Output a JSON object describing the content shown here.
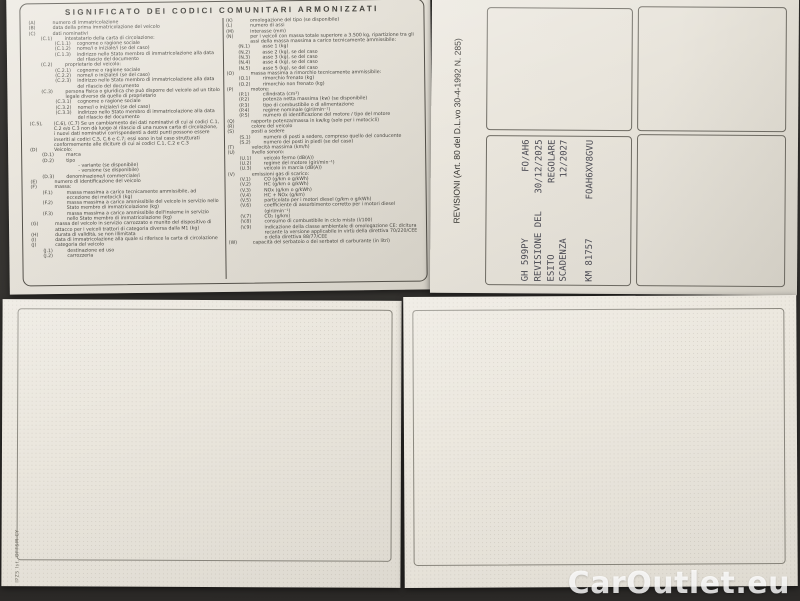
{
  "photo": {
    "watermark": "CarOutlet.eu",
    "edge_print": "IPZS Ist. OFFSM-CY"
  },
  "legend": {
    "title": "SIGNIFICATO DEI CODICI COMUNITARI ARMONIZZATI",
    "left": [
      {
        "code": "(A)",
        "text": "numero di immatricolazione",
        "level": 0
      },
      {
        "code": "(B)",
        "text": "data della prima immatricolazione del veicolo",
        "level": 0
      },
      {
        "code": "(C)",
        "text": "dati nominativi",
        "level": 0
      },
      {
        "code": "(C.1)",
        "text": "intestatario della carta di circolazione:",
        "level": 1
      },
      {
        "code": "(C.1.1)",
        "text": "cognome o ragione sociale",
        "level": 2
      },
      {
        "code": "(C.1.2)",
        "text": "nome/i o iniziale/i (se del caso)",
        "level": 2
      },
      {
        "code": "(C.1.3)",
        "text": "indirizzo nello Stato membro di immatricolazione alla data del rilascio del documento",
        "level": 2
      },
      {
        "code": "(C.2)",
        "text": "proprietario del veicolo:",
        "level": 1
      },
      {
        "code": "(C.2.1)",
        "text": "cognome o ragione sociale",
        "level": 2
      },
      {
        "code": "(C.2.2)",
        "text": "nome/i o iniziale/i (se del caso)",
        "level": 2
      },
      {
        "code": "(C.2.3)",
        "text": "indirizzo nello Stato membro di immatricolazione alla data del rilascio del documento",
        "level": 2
      },
      {
        "code": "(C.3)",
        "text": "persona fisica o giuridica che può disporre del veicolo ad un titolo legale diverso da quello di proprietario",
        "level": 1
      },
      {
        "code": "(C.3.1)",
        "text": "cognome o ragione sociale",
        "level": 2
      },
      {
        "code": "(C.3.2)",
        "text": "nome/i o iniziale/i (se del caso)",
        "level": 2
      },
      {
        "code": "(C.3.3)",
        "text": "indirizzo nello Stato membro di immatricolazione alla data del rilascio del documento",
        "level": 2
      },
      {
        "code": "(C.5),",
        "text": "(C.6), (C.7) Se un cambiamento dei dati nominativi di cui ai codici C.1, C.2 e/o C.3 non dà luogo al rilascio di una nuova carta di circolazione, i nuovi dati nominativi corrispondenti a detti punti possono essere inseriti ai codici C.5, C.6 e C.7; essi sono in tal caso strutturati conformemente alle diciture di cui ai codici C.1, C.2 e C.3",
        "level": 0
      },
      {
        "code": "(D)",
        "text": "Veicolo:",
        "level": 0
      },
      {
        "code": "(D.1)",
        "text": "marca",
        "level": 1
      },
      {
        "code": "(D.2)",
        "text": "tipo",
        "level": 1
      },
      {
        "code": "",
        "text": "- variante (se disponibile)",
        "level": 2
      },
      {
        "code": "",
        "text": "- versione (se disponibile)",
        "level": 2
      },
      {
        "code": "(D.3)",
        "text": "denominazione/i commerciale/i",
        "level": 1
      },
      {
        "code": "(E)",
        "text": "numero di identificazione del veicolo",
        "level": 0
      },
      {
        "code": "(F)",
        "text": "massa:",
        "level": 0
      },
      {
        "code": "(F.1)",
        "text": "massa massima a carico tecnicamente ammissibile, ad eccezione dei motocicli (kg)",
        "level": 1
      },
      {
        "code": "(F.2)",
        "text": "massa massima a carico ammissibile del veicolo in servizio nello Stato membro di immatricolazione (kg)",
        "level": 1
      },
      {
        "code": "(F.3)",
        "text": "massa massima a carico ammissibile dell'insieme in servizio nello Stato membro di immatricolazione (kg)",
        "level": 1
      },
      {
        "code": "(G)",
        "text": "massa del veicolo in servizio carrozzato e munito del dispositivo di attacco per i veicoli trattori di categoria diversa dalla M1 (kg)",
        "level": 0
      },
      {
        "code": "(H)",
        "text": "durata di validità, se non illimitata",
        "level": 0
      },
      {
        "code": "(I)",
        "text": "data di immatricolazione alla quale si riferisce la carta di circolazione",
        "level": 0
      },
      {
        "code": "(J)",
        "text": "categoria del veicolo",
        "level": 0
      },
      {
        "code": "(J.1)",
        "text": "destinazione ed uso",
        "level": 1
      },
      {
        "code": "(J.2)",
        "text": "carrozzeria",
        "level": 1
      }
    ],
    "right": [
      {
        "code": "(K)",
        "text": "omologazione del tipo (se disponibile)",
        "level": 0
      },
      {
        "code": "(L)",
        "text": "numero di assi",
        "level": 0
      },
      {
        "code": "(M)",
        "text": "interasse (mm)",
        "level": 0
      },
      {
        "code": "(N)",
        "text": "per i veicoli con massa totale superiore a 3.500 kg, ripartizione tra gli assi della massa massima a carico tecnicamente ammissibile:",
        "level": 0
      },
      {
        "code": "(N.1)",
        "text": "asse 1 (kg)",
        "level": 1
      },
      {
        "code": "(N.2)",
        "text": "asse 2 (kg), se del caso",
        "level": 1
      },
      {
        "code": "(N.3)",
        "text": "asse 3 (kg), se del caso",
        "level": 1
      },
      {
        "code": "(N.4)",
        "text": "asse 4 (kg), se del caso",
        "level": 1
      },
      {
        "code": "(N.5)",
        "text": "asse 5 (kg), se del caso",
        "level": 1
      },
      {
        "code": "(O)",
        "text": "massa massima a rimorchio tecnicamente ammissibile:",
        "level": 0
      },
      {
        "code": "(O.1)",
        "text": "rimorchio frenato (kg)",
        "level": 1
      },
      {
        "code": "(O.2)",
        "text": "rimorchio non frenato (kg)",
        "level": 1
      },
      {
        "code": "(P)",
        "text": "motore:",
        "level": 0
      },
      {
        "code": "(P.1)",
        "text": "cilindrata (cm³)",
        "level": 1
      },
      {
        "code": "(P.2)",
        "text": "potenza netta massima (kw) (se disponibile)",
        "level": 1
      },
      {
        "code": "(P.3)",
        "text": "tipo di combustibile o di alimentazione",
        "level": 1
      },
      {
        "code": "(P.4)",
        "text": "regime nominale (giri/min⁻¹)",
        "level": 1
      },
      {
        "code": "(P.5)",
        "text": "numero di identificazione del motore / tipo del motore",
        "level": 1
      },
      {
        "code": "(Q)",
        "text": "rapporto potenza/massa in kw/kg (solo per i motocicli)",
        "level": 0
      },
      {
        "code": "(R)",
        "text": "colore del veicolo",
        "level": 0
      },
      {
        "code": "(S)",
        "text": "posti a sedere",
        "level": 0
      },
      {
        "code": "(S.1)",
        "text": "numero di posti a sedere, compreso quello del conducente",
        "level": 1
      },
      {
        "code": "(S.2)",
        "text": "numero dei posti in piedi (se del caso)",
        "level": 1
      },
      {
        "code": "(T)",
        "text": "velocità massima (km/h)",
        "level": 0
      },
      {
        "code": "(U)",
        "text": "livello sonoro:",
        "level": 0
      },
      {
        "code": "(U.1)",
        "text": "veicolo fermo (dB(A))",
        "level": 1
      },
      {
        "code": "(U.2)",
        "text": "regime del motore (giri/min⁻¹)",
        "level": 1
      },
      {
        "code": "(U.3)",
        "text": "veicolo in marcia (dB(A))",
        "level": 1
      },
      {
        "code": "(V)",
        "text": "emissioni gas di scarico:",
        "level": 0
      },
      {
        "code": "(V.1)",
        "text": "CO (g/km o g/kWh)",
        "level": 1
      },
      {
        "code": "(V.2)",
        "text": "HC (g/km o g/kWh)",
        "level": 1
      },
      {
        "code": "(V.3)",
        "text": "NOx (g/km o g/kWh)",
        "level": 1
      },
      {
        "code": "(V.4)",
        "text": "HC + NOx (g/km)",
        "level": 1
      },
      {
        "code": "(V.5)",
        "text": "particolato per i motori diesel (g/km o g/kWh)",
        "level": 1
      },
      {
        "code": "(V.6)",
        "text": "coefficiente di assorbimento corretto per i motori diesel (giri/min⁻¹)",
        "level": 1
      },
      {
        "code": "(V.7)",
        "text": "CO₂ (g/km)",
        "level": 1
      },
      {
        "code": "(V.8)",
        "text": "consumo di combustibile in ciclo misto (l/100)",
        "level": 1
      },
      {
        "code": "(V.9)",
        "text": "indicazione della classe ambientale di omologazione CE: dicitura recante la versione applicabile in virtù della direttiva 70/220/CEE o della direttiva 88/77/CEE",
        "level": 1
      },
      {
        "code": "(W)",
        "text": "capacità del serbatoio o dei serbatoi di carburante (in litri)",
        "level": 0
      }
    ]
  },
  "revisioni": {
    "header": "REVISIONI (Art. 80 del D.L.vo 30-4-1992 N. 285)",
    "stamp_rows": [
      {
        "label": "GH 599PY",
        "value": "FO/AH6",
        "cls": ""
      },
      {
        "label": "REVISIONE DEL",
        "value": "30/12/2025",
        "cls": ""
      },
      {
        "label": "ESITO",
        "value": "REGOLARE",
        "cls": ""
      },
      {
        "label": "SCADENZA",
        "value": "12/2027",
        "cls": ""
      },
      {
        "label": "KM 81757",
        "value": "FOAH6XV8GVU",
        "cls": "gap"
      }
    ]
  },
  "colors": {
    "paper": "#e9e5dc",
    "background": "#343230",
    "ink": "#474640",
    "stamp_ink": "#4b4b54",
    "watermark": "#ffffff"
  }
}
